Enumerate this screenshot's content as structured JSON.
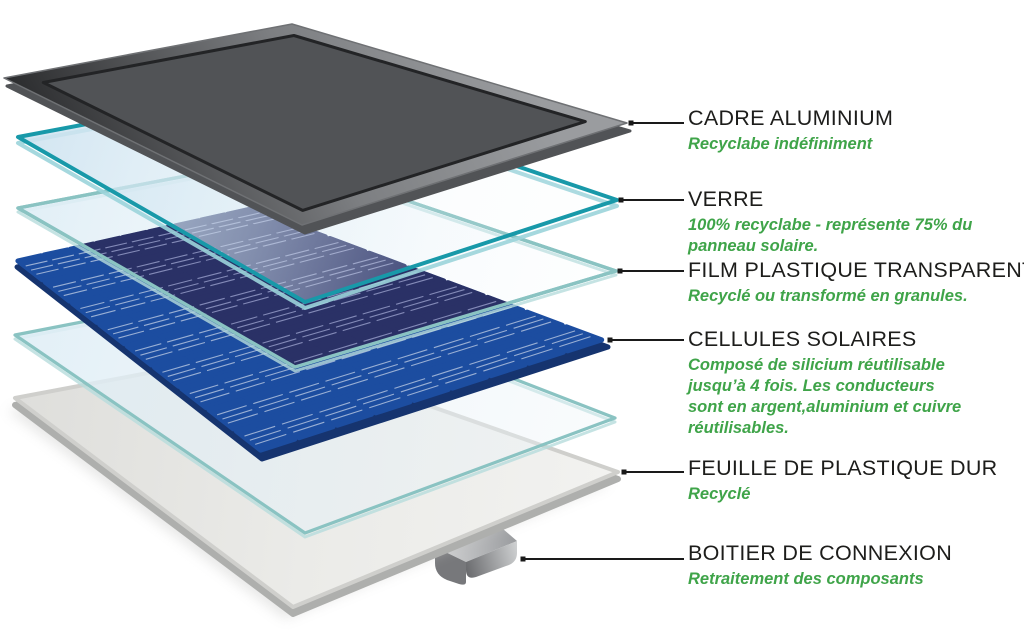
{
  "layers": [
    {
      "id": "cadre-aluminium",
      "heading": "CADRE ALUMINIUM",
      "subtitle_lines": [
        "Recyclabe indéfiniment"
      ]
    },
    {
      "id": "verre",
      "heading": "VERRE",
      "subtitle_lines": [
        "100% recyclabe - représente 75% du",
        "panneau solaire."
      ]
    },
    {
      "id": "film-plastique-transparent",
      "heading": "FILM PLASTIQUE TRANSPARENT",
      "subtitle_lines": [
        "Recyclé ou transformé en granules."
      ]
    },
    {
      "id": "cellules-solaires",
      "heading": "CELLULES SOLAIRES",
      "subtitle_lines": [
        "Composé de silicium réutilisable",
        "jusqu’à 4 fois. Les conducteurs",
        "sont en argent,aluminium et cuivre",
        "réutilisables."
      ]
    },
    {
      "id": "feuille-de-plastique-dur",
      "heading": "FEUILLE DE PLASTIQUE DUR",
      "subtitle_lines": [
        "Recyclé"
      ]
    },
    {
      "id": "boitier-de-connexion",
      "heading": "BOITIER DE CONNEXION",
      "subtitle_lines": [
        "Retraitement des composants"
      ]
    }
  ],
  "colors": {
    "heading_text": "#1d1d1b",
    "subtitle_green": "#3fa449",
    "leader_line": "#1a1a1a",
    "glass_border_teal": "#1899a9",
    "glass_fill_blue": "#cee3f0",
    "film_border_teal": "#8ac3c2",
    "cell_dark_navy": "#2a3166",
    "cell_bright_blue": "#1c4da0",
    "cell_shadow_navy": "#16346f",
    "cell_gap_lavender": "#a3a9d4",
    "frame_gray_light": "#9a9c9f",
    "frame_gray_mid": "#7d7f82",
    "frame_gray_dark": "#2b2c2e",
    "backsheet_white": "#f2f2f0",
    "backsheet_edge_gray": "#aeafad",
    "junction_box_gray": "#808285"
  }
}
